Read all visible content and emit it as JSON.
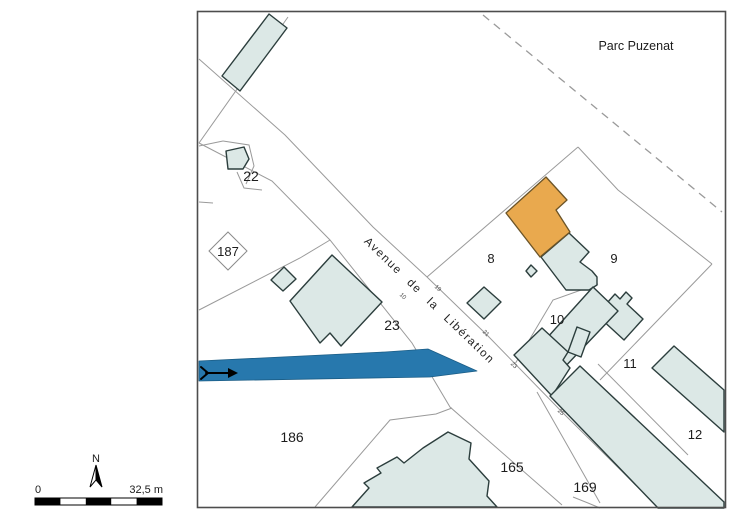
{
  "map": {
    "area_label": "Parc Puzenat",
    "road_name": "Avenue de la Libération",
    "parcels": {
      "p22": "22",
      "p187": "187",
      "p23": "23",
      "p186": "186",
      "p165": "165",
      "p169": "169",
      "p8": "8",
      "p9": "9",
      "p10": "10",
      "p11": "11",
      "p12": "12"
    },
    "address_numbers": {
      "a10": "10",
      "a19": "19",
      "a21": "21",
      "a23": "23",
      "a25": "25"
    },
    "highlights": {
      "selected_building_color": "#e9a94e",
      "selected_path_color": "#2778ad"
    },
    "colors": {
      "building_fill": "#dce8e6",
      "building_stroke": "#2c3e3d",
      "parcel_line": "#9a9a9a",
      "map_border": "#4d4d4d"
    }
  },
  "legend": {
    "north_label": "N",
    "scale_start": "0",
    "scale_end": "32,5 m"
  }
}
